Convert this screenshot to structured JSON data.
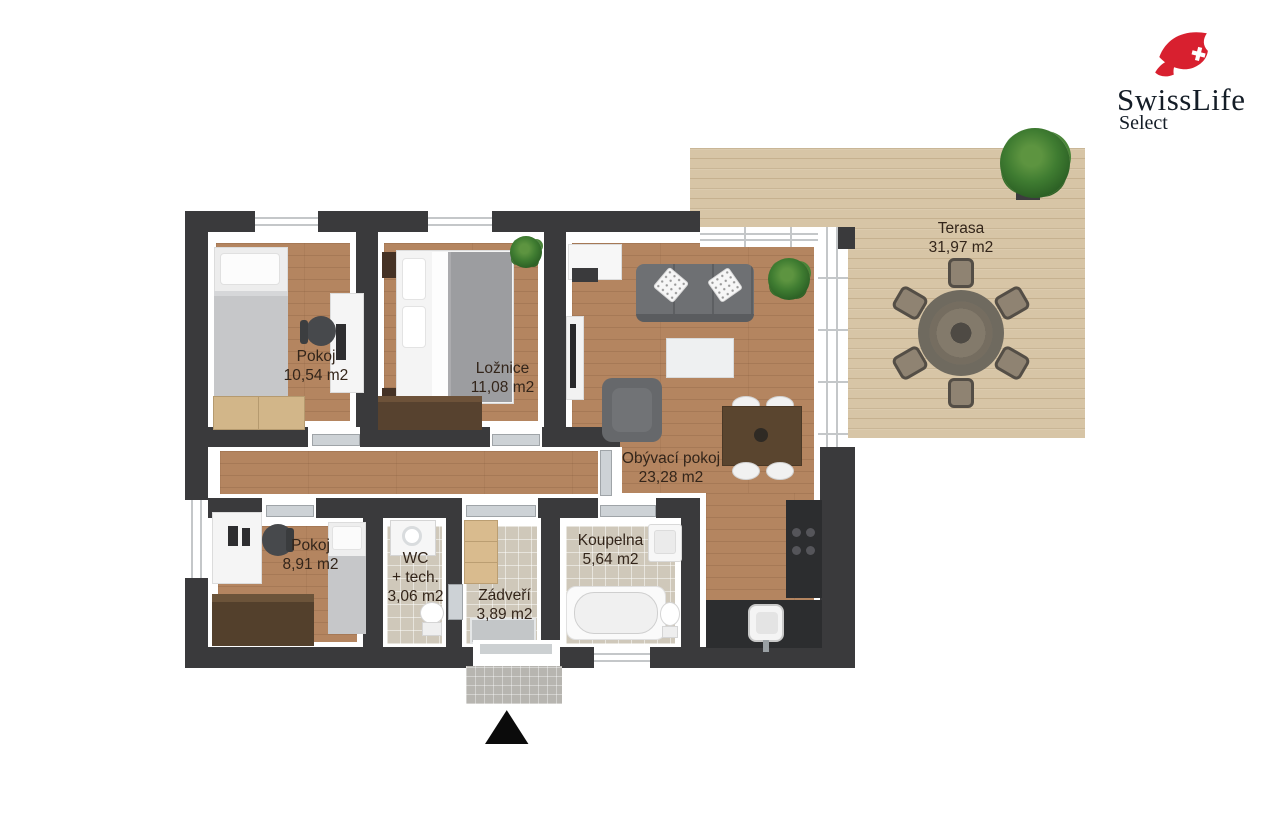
{
  "brand": {
    "name": "SwissLife",
    "subname": "Select"
  },
  "rooms": {
    "pokoj1": {
      "name": "Pokoj",
      "area": "10,54 m2"
    },
    "loznice": {
      "name": "Ložnice",
      "area": "11,08 m2"
    },
    "obyvaci": {
      "name": "Obývací pokoj",
      "area": "23,28 m2"
    },
    "terasa": {
      "name": "Terasa",
      "area": "31,97 m2"
    },
    "pokoj2": {
      "name": "Pokoj",
      "area": "8,91 m2"
    },
    "wc": {
      "name": "WC",
      "name_line2": "+ tech.",
      "area": "3,06 m2"
    },
    "zadveri": {
      "name": "Zádveří",
      "area": "3,89 m2"
    },
    "koupelna": {
      "name": "Koupelna",
      "area": "5,64 m2"
    }
  },
  "icons": {
    "entrance_arrow": "▲"
  },
  "colors": {
    "brand_red": "#d8202f",
    "logo_text": "#141d27",
    "wall": "#3a3a3c",
    "floor_wood": "#b48560",
    "terrace_wood": "#d7c5a6",
    "tile": "#cfc8ba",
    "label_text": "#33251a"
  }
}
